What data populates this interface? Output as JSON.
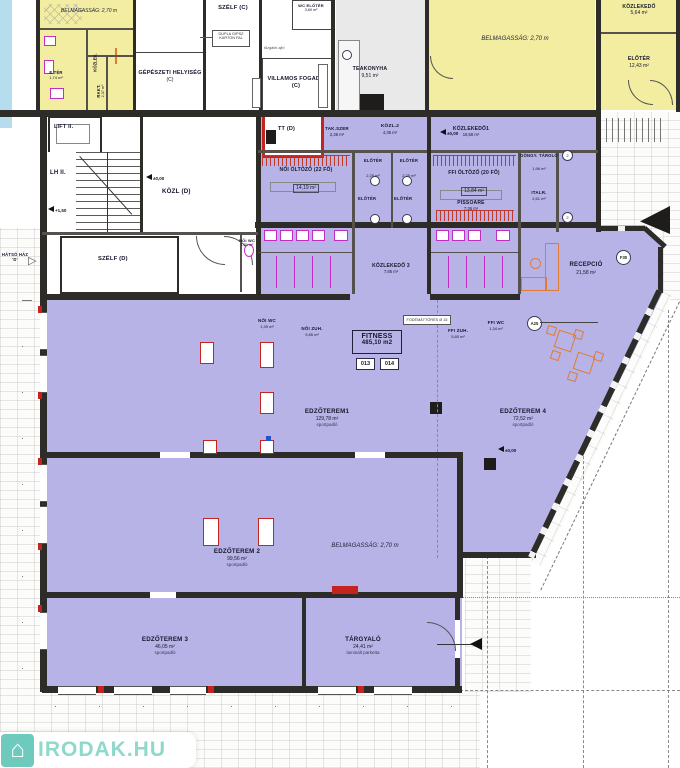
{
  "labels": {
    "ceiling_height": "BELMAGASSÁG: 2,70 m"
  },
  "rooms": {
    "eter": {
      "name": "E.TÉR",
      "area": "1,74 m²"
    },
    "kozlek_tl": {
      "name": "KÖZLEK."
    },
    "rakt": {
      "name": "RAKT.",
      "area": "2,37 m²"
    },
    "gepeszeti": {
      "name": "GÉPÉSZETI HELYISÉG",
      "area": "(C)"
    },
    "szelf_c": {
      "name": "SZÉLF (C)"
    },
    "villamos": {
      "name": "VILLAMOS FOGADÓ (C)"
    },
    "wc_eloter": {
      "name": "WC ELŐTÉR",
      "area": "3,69 m²"
    },
    "teakonyha": {
      "name": "TEAKONYHA",
      "area": "9,51 m²"
    },
    "kozlekedo_tr": {
      "name": "KÖZLEKEDŐ",
      "area": "5,64 m²"
    },
    "eloter_tr": {
      "name": "ELŐTÉR",
      "area": "12,43 m²"
    },
    "lift": {
      "name": "LIFT II."
    },
    "lh": {
      "name": "LH II."
    },
    "kozl_d": {
      "name": "KÖZL (D)"
    },
    "szelf_d": {
      "name": "SZÉLF (D)"
    },
    "tt_d": {
      "name": "TT (D)"
    },
    "tak_szer": {
      "name": "TAK.SZER",
      "area": "2,36 m²"
    },
    "kozl2": {
      "name": "KÖZL.2",
      "area": "4,35 m²"
    },
    "noi_oltozo": {
      "name": "NŐI ÖLTÖZŐ (22 FŐ)",
      "area": "14,19 m²"
    },
    "eloter_a": {
      "name": "ELŐTÉR",
      "area": "2,25 m²"
    },
    "eloter_b": {
      "name": "ELŐTÉR",
      "area": "2,25 m²"
    },
    "eloter_c": {
      "name": "ELŐTÉR"
    },
    "eloter_d": {
      "name": "ELŐTÉR"
    },
    "kozlekedo1": {
      "name": "KÖZLEKEDŐ1",
      "area": "16,58 m²"
    },
    "ffi_oltozo": {
      "name": "FFI ÖLTÖZŐ (20 FŐ)",
      "area": "13,84 m²"
    },
    "pissoare": {
      "name": "PISSOARE",
      "area": "7,36 m²"
    },
    "gongy": {
      "name": "GÖNGY. TÁROLÓ",
      "area": "1,96 m²"
    },
    "italr": {
      "name": "ITALR.",
      "area": "2,61 m²"
    },
    "kozlekedo3": {
      "name": "KÖZLEKEDŐ 3",
      "area": "7,85 m²"
    },
    "noi_wc_band": {
      "name": "NŐI WC",
      "area": "1,31 m²"
    },
    "noi_wc": {
      "name": "NŐI WC",
      "area": "1,39 m²"
    },
    "noi_zuh": {
      "name": "NŐI ZUH.",
      "area": "9,85 m²"
    },
    "ffi_zuh": {
      "name": "FFI ZUH.",
      "area": "5,80 m²"
    },
    "ffi_wc": {
      "name": "FFI WC",
      "area": "1,34 m²"
    },
    "recepcio": {
      "name": "RECEPCIÓ",
      "area": "21,58 m²"
    },
    "fitness": {
      "name": "FITNESS",
      "area": "485,10 m2"
    },
    "edzoterem1": {
      "name": "EDZŐTEREM1",
      "area": "129,78 m²",
      "floor": "sportpadló"
    },
    "edzoterem2": {
      "name": "EDZŐTEREM 2",
      "area": "99,56 m²",
      "floor": "sportpadló"
    },
    "edzoterem3": {
      "name": "EDZŐTEREM 3",
      "area": "46,05 m²",
      "floor": "sportpadló"
    },
    "edzoterem4": {
      "name": "EDZŐTEREM 4",
      "area": "72,52 m²",
      "floor": "sportpadló"
    },
    "targyalo": {
      "name": "TÁRGYALÓ",
      "area": "24,41 m²",
      "floor": "laminált parketta"
    }
  },
  "markers": {
    "level_0": "±0,00",
    "level_150": "+1,50",
    "room_013": "013",
    "room_014": "014",
    "f30": "F30",
    "a25": "A25",
    "circle_2": "2",
    "rear_entrance": "HÁTSÓ HÁZ 'D'",
    "slab_note": "FÖDÉMÁTTÖRÉS Ø 15",
    "wall_note": "DUPLA GIPSZ KARTON FAL",
    "fire_door_note": "tűzgátló ajtó"
  },
  "watermark": {
    "text": "IRODAK.HU"
  },
  "colors": {
    "room_purple": "#b7b3e6",
    "room_yellow": "#f2eda1",
    "wall_dark": "#2e2c29",
    "accent_red": "#c42420",
    "fixture_magenta": "#c32cc3",
    "furniture_orange": "#e07b35",
    "watermark_teal": "#8fd8cc",
    "water_blue": "#b5ddee"
  }
}
